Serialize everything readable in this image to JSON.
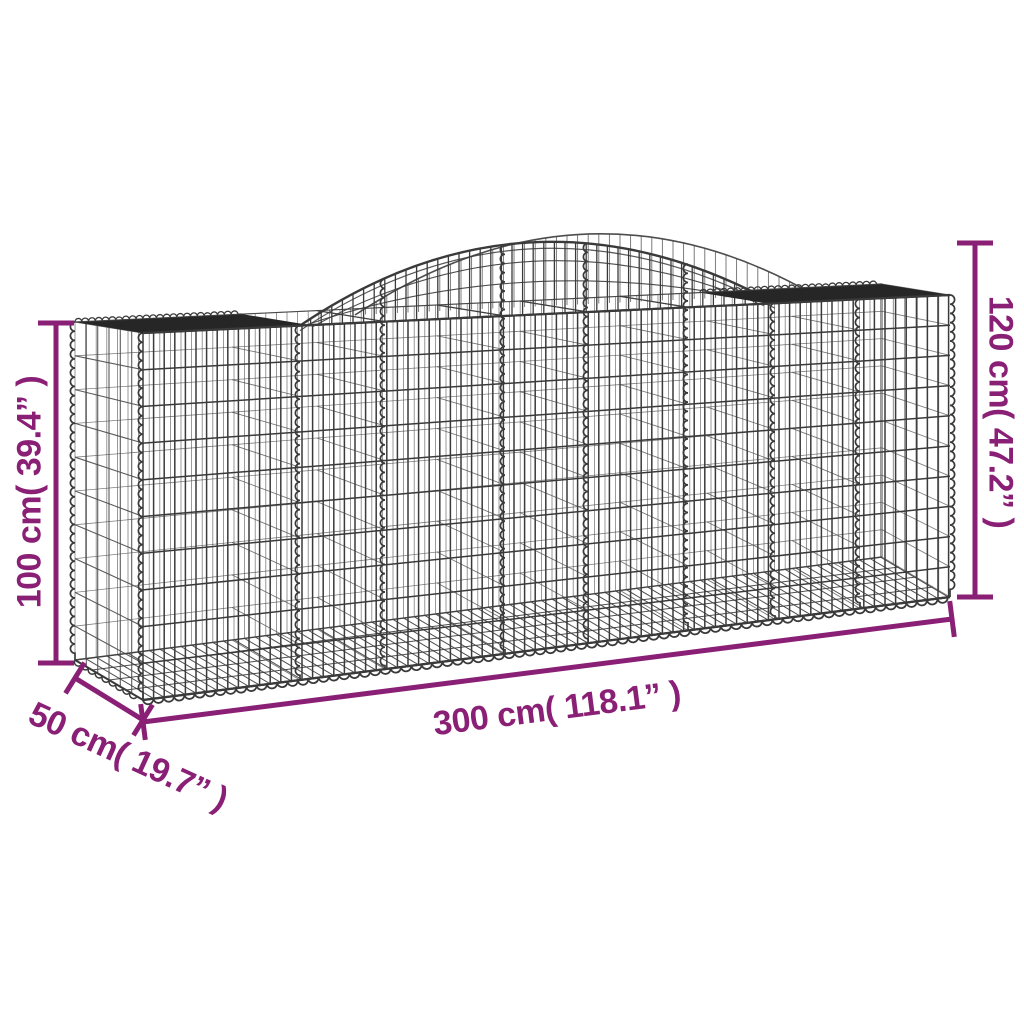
{
  "title": "Arched gabion basket dimension diagram",
  "background": "#FFFFFF",
  "colors": {
    "annotation": "#8A2076",
    "wire": "#3A3A3A",
    "wire_light": "#4A4A4A",
    "rim_dark": "#262626"
  },
  "diagram": {
    "product": "arched-gabion-basket-wireframe",
    "annotations": {
      "side_height": {
        "text": "100 cm( 39.4” )",
        "value_cm": 100,
        "value_in": 39.4,
        "position": "left-vertical"
      },
      "total_height": {
        "text": "120 cm( 47.2” )",
        "value_cm": 120,
        "value_in": 47.2,
        "position": "right-vertical"
      },
      "length": {
        "text": "300 cm( 118.1” )",
        "value_cm": 300,
        "value_in": 118.1,
        "position": "bottom-slanted"
      },
      "depth": {
        "text": "50 cm( 19.7” )",
        "value_cm": 50,
        "value_in": 19.7,
        "position": "bottom-left-diagonal"
      }
    }
  }
}
